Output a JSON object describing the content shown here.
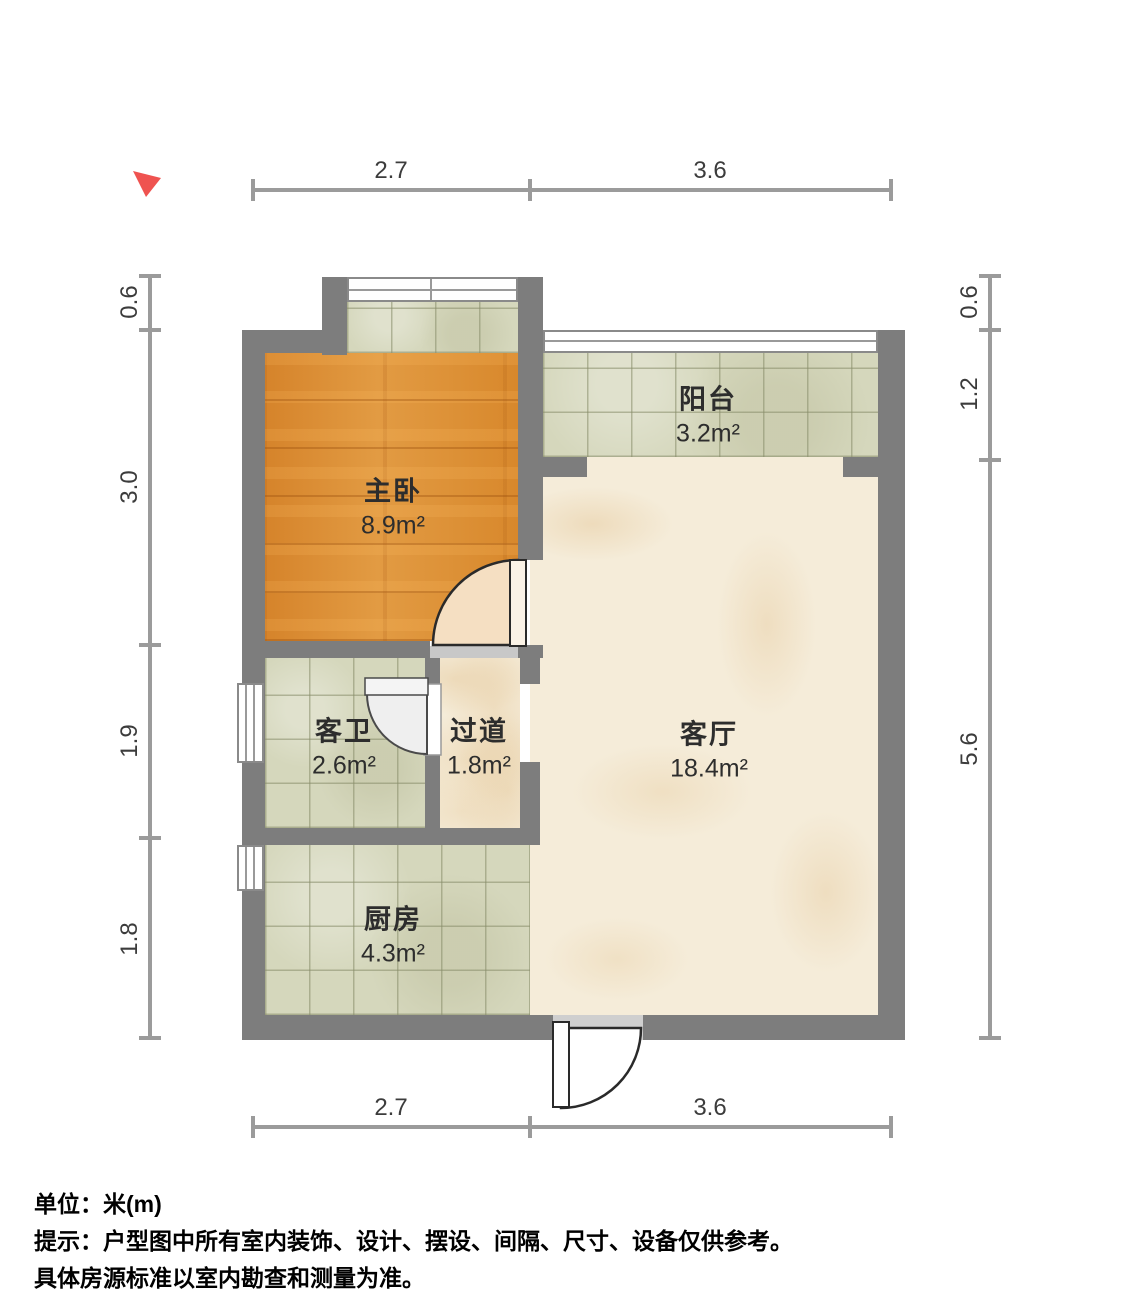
{
  "legend": {
    "unit_line": "单位：米(m)",
    "tip_line1": "提示：户型图中所有室内装饰、设计、摆设、间隔、尺寸、设备仅供参考。",
    "tip_line2": "具体房源标准以室内勘查和测量为准。"
  },
  "rooms": [
    {
      "name": "主卧",
      "area": "8.9m²",
      "floor": "wood"
    },
    {
      "name": "阳台",
      "area": "3.2m²",
      "floor": "tile"
    },
    {
      "name": "客卫",
      "area": "2.6m²",
      "floor": "tile"
    },
    {
      "name": "过道",
      "area": "1.8m²",
      "floor": "marble"
    },
    {
      "name": "客厅",
      "area": "18.4m²",
      "floor": "marble"
    },
    {
      "name": "厨房",
      "area": "4.3m²",
      "floor": "tile"
    }
  ],
  "dimensions": {
    "top": [
      "2.7",
      "3.6"
    ],
    "bottom": [
      "2.7",
      "3.6"
    ],
    "left": [
      "0.6",
      "3.0",
      "1.9",
      "1.8"
    ],
    "right": [
      "0.6",
      "1.2",
      "5.6"
    ]
  },
  "colors": {
    "wall": "#7d7d7d",
    "wood_floor": "#d98c2e",
    "tile_floor": "#d5d7bc",
    "marble_floor": "#f5ecd9",
    "compass_red": "#ef5350",
    "dimension_gray": "#9b9b9b",
    "door_fill": "#f5dfc2"
  }
}
